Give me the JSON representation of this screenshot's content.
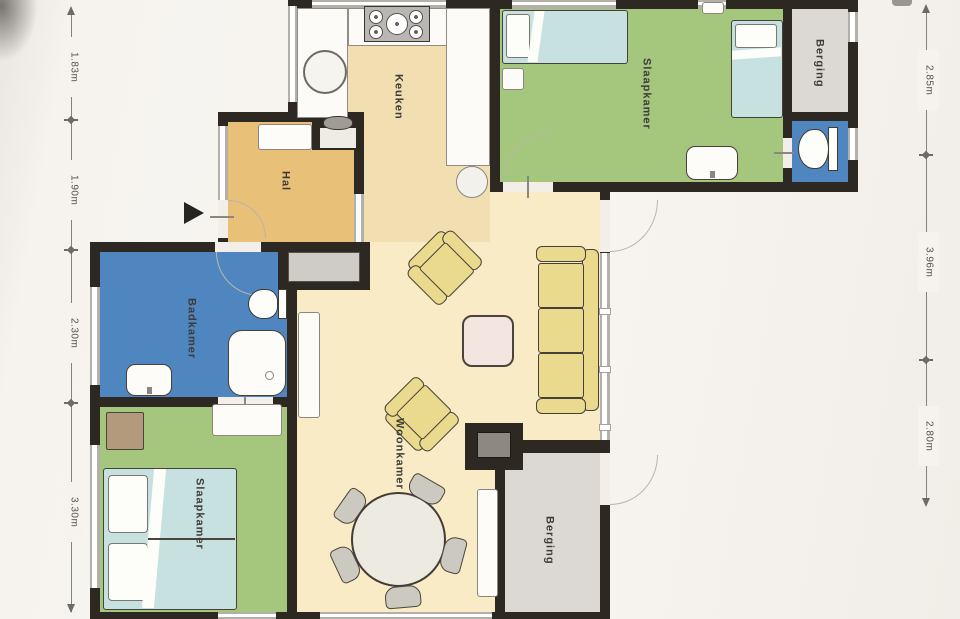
{
  "plan": {
    "type": "floor-plan",
    "language": "nl"
  },
  "rooms": {
    "keuken": {
      "label": "Keuken"
    },
    "slaapkamer_top": {
      "label": "Slaapkamer"
    },
    "berging_top": {
      "label": "Berging"
    },
    "hal": {
      "label": "Hal"
    },
    "badkamer": {
      "label": "Badkamer"
    },
    "woonkamer": {
      "label": "Woonkamer"
    },
    "slaapkamer_bottom": {
      "label": "Slaapkamer"
    },
    "berging_bottom": {
      "label": "Berging"
    }
  },
  "dimensions": {
    "left": [
      {
        "label": "1.83m"
      },
      {
        "label": "1.90m"
      },
      {
        "label": "2.30m"
      },
      {
        "label": "3.30m"
      }
    ],
    "right": [
      {
        "label": "2.85m"
      },
      {
        "label": "3.96m"
      },
      {
        "label": "2.80m"
      }
    ]
  },
  "colors": {
    "wall": "#2e2822",
    "kitchen_floor": "#f1dfb2",
    "living_floor": "#f8ebc6",
    "hall_floor": "#e9c077",
    "bedroom_floor": "#a5c77d",
    "bathroom_floor": "#4f86c0",
    "storage_floor": "#dcd9d4",
    "bed_blue": "#c7e0e0",
    "seat_yellow": "#eada8d",
    "coffee_table_pink": "#f3e6e1",
    "counter_white": "#fcfbf8",
    "window_frame": "#b3b0aa",
    "furniture_outline": "#46403a",
    "page_bg": "#f6f3ef",
    "label_text": "#3d3b37",
    "dim_text": "#55514b"
  }
}
